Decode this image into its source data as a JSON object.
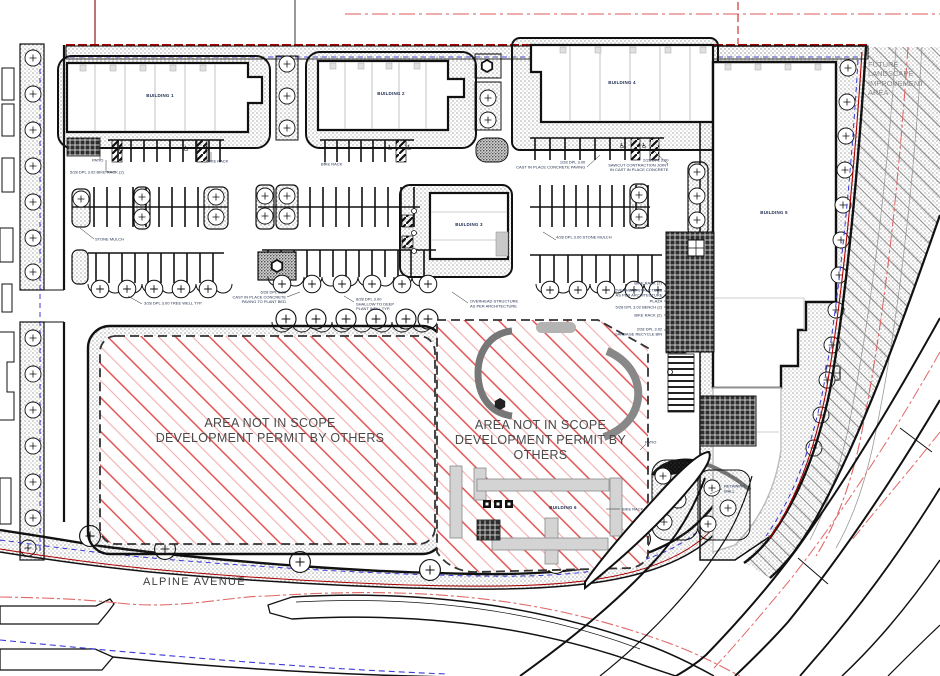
{
  "title": "Landscape Site Plan",
  "streets": {
    "alpine_avenue": "ALPINE AVENUE"
  },
  "zones": {
    "future_landscape": "FUTURE LANDSCAPE\nIMPROVEMENT AREA",
    "scope_left": "AREA NOT IN SCOPE\nDEVELOPMENT PERMIT BY OTHERS",
    "scope_right": "AREA NOT IN SCOPE\nDEVELOPMENT PERMIT BY OTHERS"
  },
  "buildings": [
    {
      "label": "BUILDING 1"
    },
    {
      "label": "BUILDING 2"
    },
    {
      "label": "BUILDING 3"
    },
    {
      "label": "BUILDING 4"
    },
    {
      "label": "BUILDING 5"
    },
    {
      "label": "BUILDING 6"
    }
  ],
  "annotations": [
    {
      "text": "PATIO"
    },
    {
      "text": "5/28 DPL 3.02 BIKE RACK (2)"
    },
    {
      "text": "BIKE RACK"
    },
    {
      "text": "BIKE RACK"
    },
    {
      "text": "1/28 DPL 3.00\nCAST IN PLACE CONCRETE PAVING"
    },
    {
      "text": "2/28 DPL 3.00\nSAWCUT CONTRACTION JOINT\nIN CAST IN PLACE CONCRETE"
    },
    {
      "text": "STONE MULCH"
    },
    {
      "text": "4/28 DPL 3.00 STONE MULCH"
    },
    {
      "text": "3/28 DPL 3.00 TREE WELL TYP."
    },
    {
      "text": "6/28 DPL 3.00\nCAST IN PLACE CONCRETE\nPAVING TO PLANT BED"
    },
    {
      "text": "8/28 DPL 3.00\nSHALLOW TO DEEP\nPLANT WELL TYP."
    },
    {
      "text": "OVERHEAD STRUCTURE\nAS PER ARCHITECTURE"
    },
    {
      "text": "BIKE RACK (2)"
    },
    {
      "text": "OVERHEAD STRUCTURE\nAS PER ARCHITECTURE"
    },
    {
      "text": "PLAZA"
    },
    {
      "text": "5/28 DPL 3.02 BENCH (2)"
    },
    {
      "text": "BIKE RACK (2)"
    },
    {
      "text": "2/28 DPL 3.02\nGARBAGE RECYCLE BIN"
    },
    {
      "text": "RETAINING\nWALL"
    },
    {
      "text": "PATIO"
    },
    {
      "text": "BIKE RACK"
    }
  ],
  "icons": {
    "accessible_parking": "♿"
  },
  "colors": {
    "hatch_red_dark": "#e04545",
    "hatch_red_light": "#f2adad",
    "property_line_red": "#aa0000",
    "centerline_red": "#e06868",
    "utility_blue": "#3a3ad6",
    "linework_black": "#111111",
    "annotation_navy": "#22304f",
    "scope_text_gray": "#4a4a4a"
  }
}
